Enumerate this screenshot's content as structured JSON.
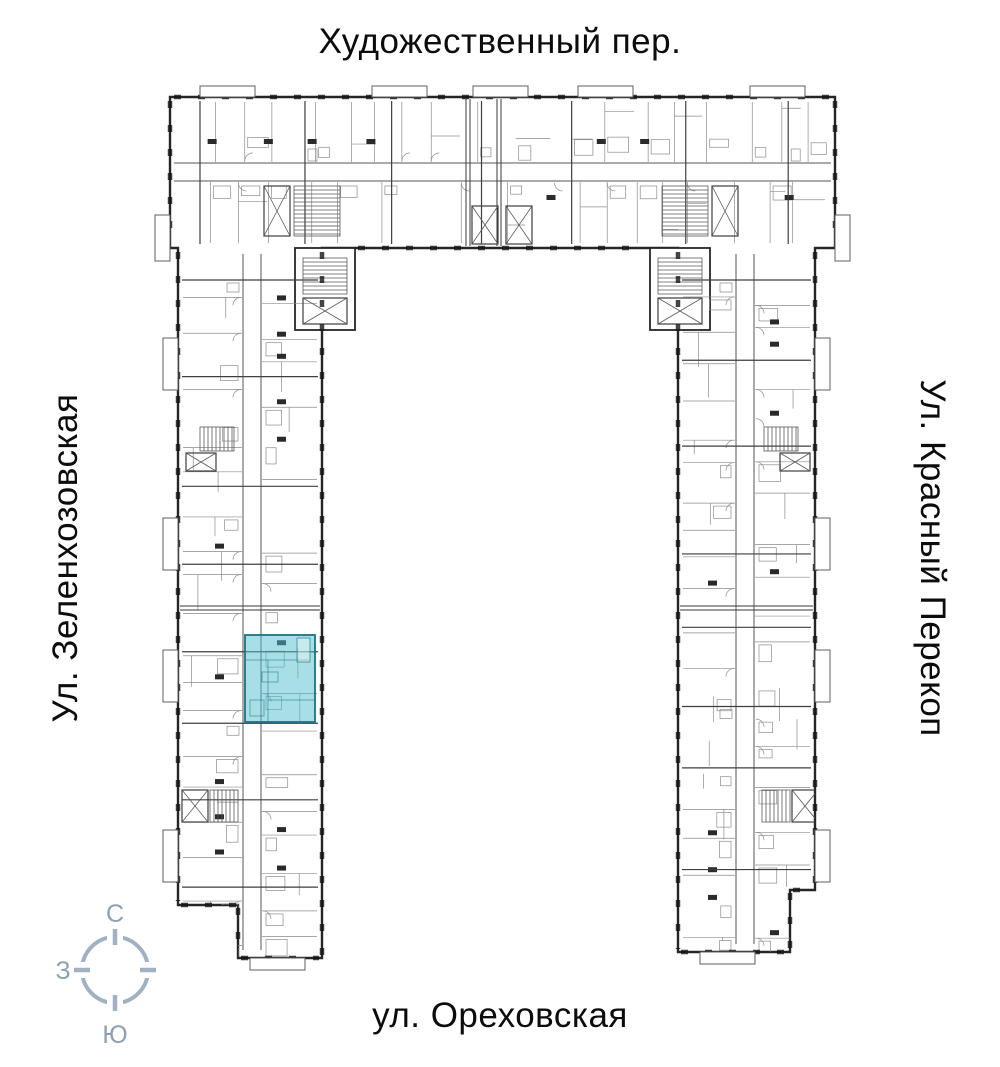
{
  "streets": {
    "top": "Художественный пер.",
    "left": "Ул. Зеленхозовская",
    "right": "Ул. Красный Перекоп",
    "bottom": "ул. Ореховская"
  },
  "compass": {
    "north_label": "С",
    "west_label": "З",
    "south_label": "Ю",
    "color": "#a2b1c1",
    "label_color": "#8da0b3"
  },
  "plan": {
    "wall_color": "#262626",
    "detail_color": "#8c8c8c",
    "highlight_fill": "rgba(82,191,205,0.5)",
    "highlight_stroke": "#1b7286"
  }
}
